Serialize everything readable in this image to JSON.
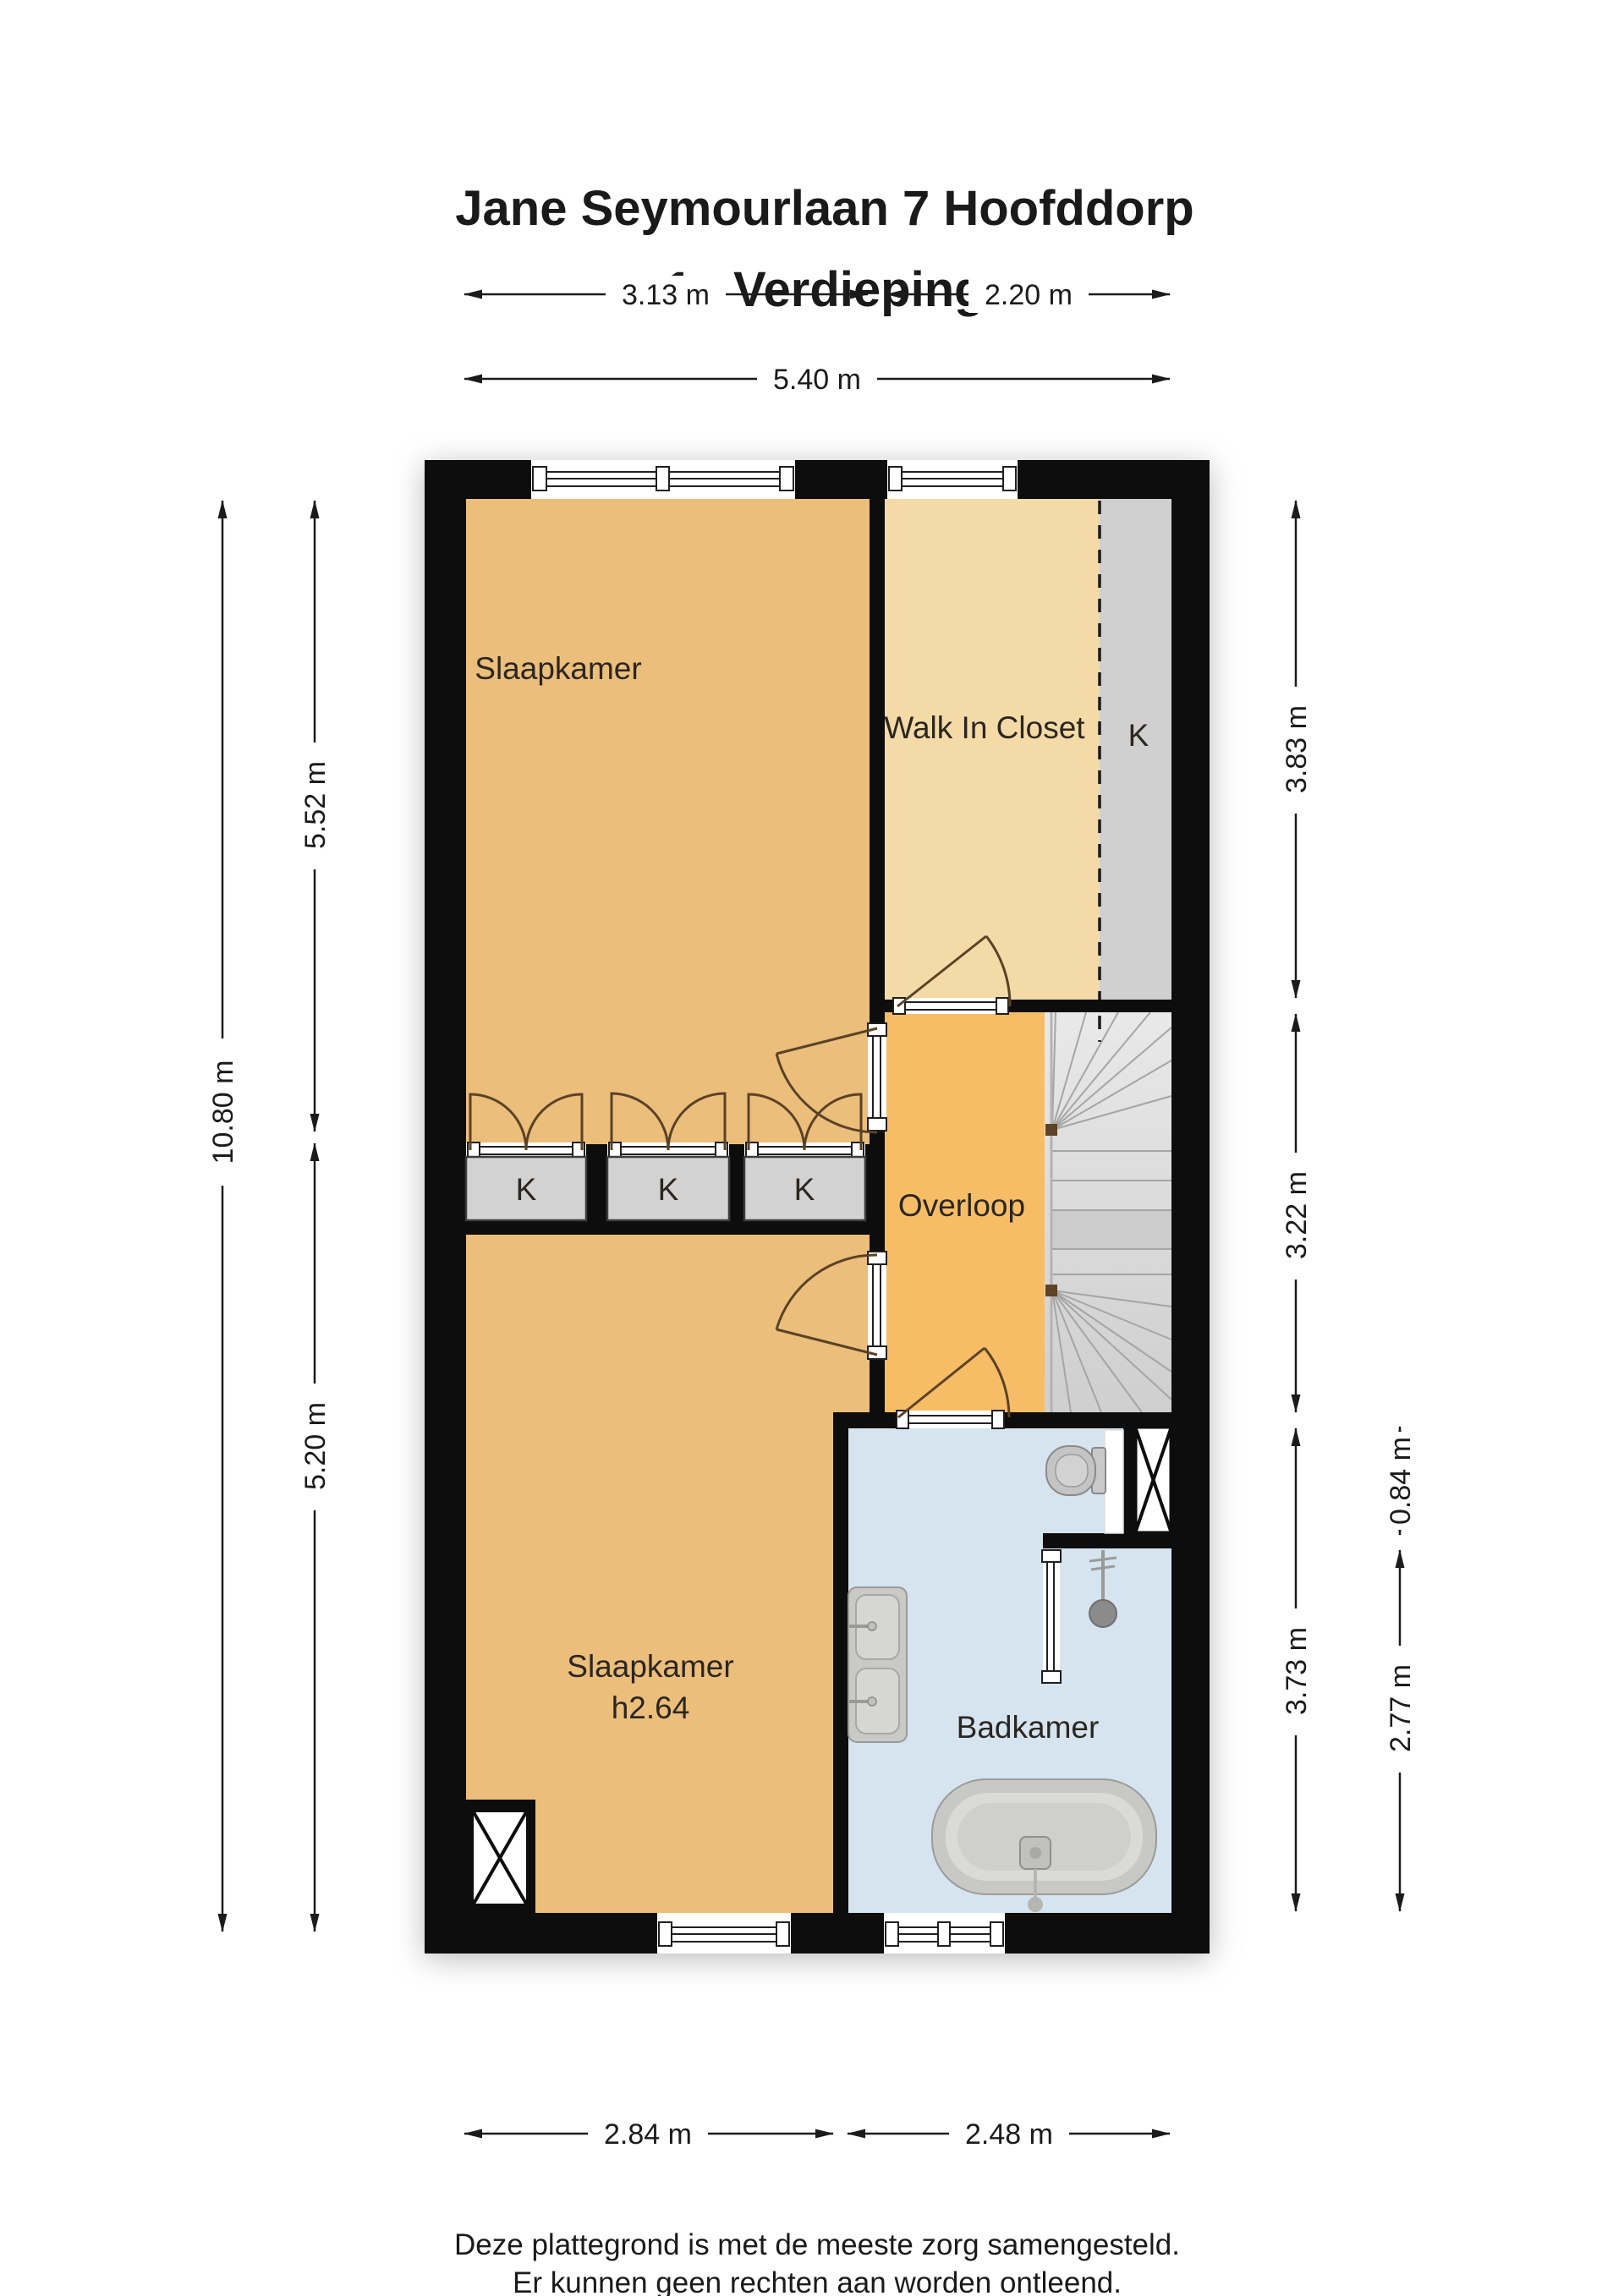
{
  "title": {
    "line1": "Jane Seymourlaan 7 Hoofddorp",
    "line2": "1e Verdieping"
  },
  "floor_plan": {
    "rooms": {
      "slaapkamer_1": {
        "label": "Slaapkamer"
      },
      "walk_in_closet": {
        "label": "Walk In Closet"
      },
      "walk_in_closet_cupboard": {
        "label": "K"
      },
      "overloop": {
        "label": "Overloop"
      },
      "kast_1": {
        "label": "K"
      },
      "kast_2": {
        "label": "K"
      },
      "kast_3": {
        "label": "K"
      },
      "slaapkamer_2": {
        "label": "Slaapkamer",
        "height_note": "h2.64"
      },
      "badkamer": {
        "label": "Badkamer"
      }
    },
    "colors": {
      "wall": "#0d0d0d",
      "bedroom_floor": "#ecbe7b",
      "closet_floor": "#f4daa7",
      "landing_floor": "#f7bd66",
      "bathroom_floor": "#d6e4f0",
      "cupboard_gray": "#d2d2d2",
      "stairs_gray": "#dcdcdc",
      "door_arc": "#5a4226"
    }
  },
  "dimensions": {
    "top_left": "3.13 m",
    "top_right": "2.20 m",
    "top_total": "5.40 m",
    "left_total": "10.80 m",
    "left_upper": "5.52 m",
    "left_lower": "5.20 m",
    "right_upper": "3.83 m",
    "right_middle": "3.22 m",
    "right_lower": "3.73 m",
    "right_inner_small": "0.84 m",
    "right_inner_large": "2.77 m",
    "bottom_left": "2.84 m",
    "bottom_right": "2.48 m"
  },
  "footer": {
    "line1": "Deze plattegrond is met de meeste zorg samengesteld.",
    "line2": "Er kunnen geen rechten aan worden ontleend."
  }
}
